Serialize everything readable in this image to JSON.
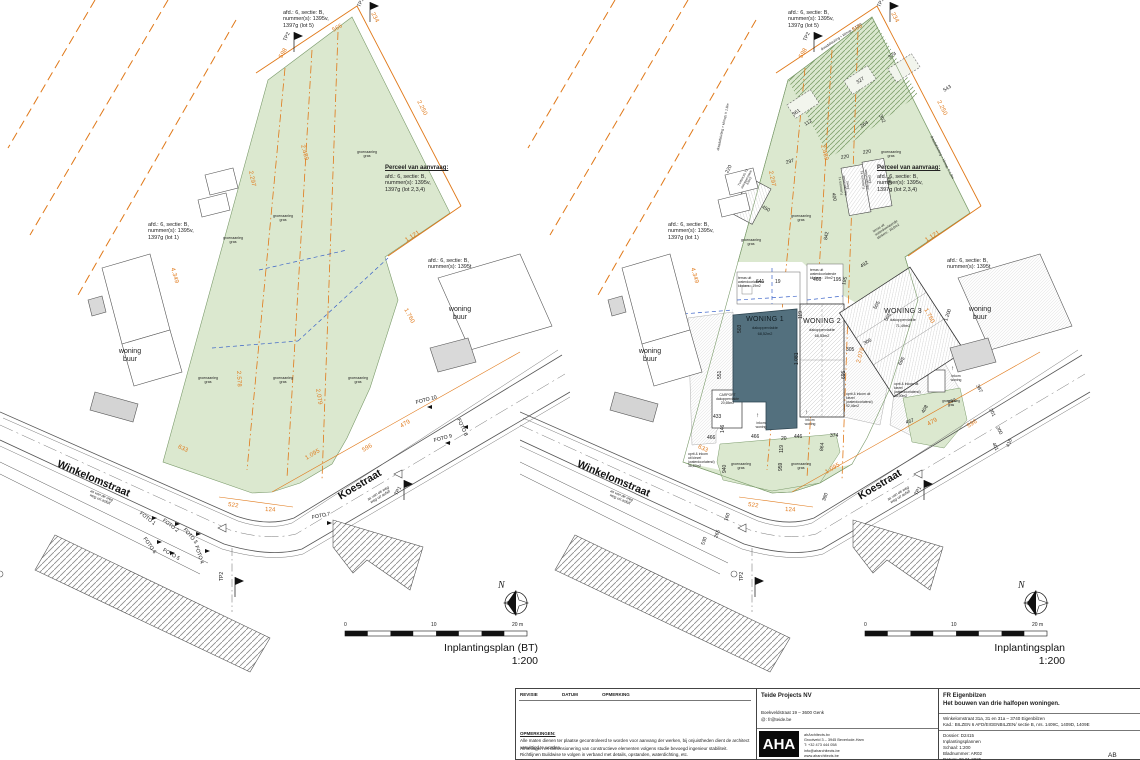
{
  "C": {
    "lot5": "afd.: 6, sectie: B,\nnummer(s): 1395v,\n1397g (lot 5)",
    "lot1": "afd.: 6, sectie: B,\nnummer(s): 1395v,\n1397g (lot 1)",
    "lot1395t": "afd.: 6, sectie: B,\nnummer(s): 1395t",
    "perceel_title": "Perceel van aanvraag:",
    "perceel_body": "afd.: 6, sectie: B,\nnummer(s): 1395v,\n1397g (lot 2,3,4)",
    "woning_buur": "woning\nbuur",
    "groen": "groenaanleg\ngras",
    "street_winkelomstraat": "Winkelomstraat",
    "street_koestraat": "Koestraat",
    "as_weg": "as van de weg\nweg uit asfalt",
    "tp1": "TP1",
    "tp2": "TP2",
    "north": "N",
    "scale_0": "0",
    "scale_10": "10",
    "scale_20": "20 m",
    "accent_orange": "#e07818",
    "green_fill": "#dbe8cf",
    "woning1_fill": "#53707e"
  },
  "L": {
    "caption": "Inplantingsplan (BT)",
    "scale": "1:200",
    "fotos": [
      "FOTO 1",
      "FOTO 2",
      "FOTO 3",
      "FOTO 4",
      "FOTO 5",
      "FOTO 6",
      "FOTO 7",
      "FOTO 8",
      "FOTO 9",
      "FOTO 10"
    ],
    "d": {
      "n598": "598",
      "n566": "566",
      "n234": "234",
      "n2250": "2.250",
      "n1121": "1.121",
      "n2297": "2.297",
      "n2489": "2.489",
      "n4349": "4.349",
      "n1760": "1.760",
      "n2578": "2.578",
      "n2079": "2.079",
      "n633": "633",
      "n522": "522",
      "n124": "124",
      "n1095": "1.095",
      "n596": "596",
      "n479": "479"
    }
  },
  "R": {
    "caption": "Inplantingsplan",
    "scale": "1:200",
    "w1": "WONING 1",
    "w1_sub": "dakoppervlakte",
    "w1_area": "68,52m2",
    "w2": "WONING 2",
    "w2_sub": "dakoppervlakte",
    "w2_area": "68,53m2",
    "w3": "WONING 3",
    "w3_sub": "dakoppervlakte",
    "w3_area": "71,49m2",
    "carport": "CARPORT\ndakoppervlakte\n20,65m2",
    "t1": "TUINHUIS T1\ndakoppervlakte\n8.8m2",
    "t2": "TUINHUIS T2\ndakoppervlakte\n8.8m2",
    "terras19": "terras uit\nwaterdoorlatende\nklinkers : 19m2",
    "terras20": "terras uit\nwaterdoorlatende\nklinkers : 20,0m2",
    "oprit1": "oprit & inkom\nuit kiezel\n(waterdoorlatend)\n36,87m2",
    "oprit2": "oprit & inkom uit\nkiezel\n(waterdoorlatend)\n92,46m2",
    "oprit3": "oprit & inkom uit\nkiezel\n(waterdoorlatend)\n45,00m2",
    "inkom": "inkom\nwoning",
    "inkom_arrow": "↑",
    "draad": "draadafsluiting + klimop, h 1,8m",
    "d": {
      "n598": "598",
      "n566": "566",
      "n234": "234",
      "n2250": "2.250",
      "n1121": "1.121",
      "n2297": "2.297",
      "n2489": "2.489",
      "n4349": "4.349",
      "n1760": "1.760",
      "n1200": "1.200",
      "n2079": "2.079",
      "n633": "633",
      "n522": "522",
      "n124": "124",
      "n1095": "1.095",
      "n596": "596",
      "n479": "479",
      "n641": "641",
      "n19": "19",
      "n466a": "466",
      "n195a": "195",
      "n195b": "195",
      "n492a": "492",
      "n505a": "505",
      "n505b": "505",
      "n306": "306",
      "n305": "305",
      "n503": "503",
      "n551": "551",
      "n119a": "119",
      "n1081": "1.081",
      "n695a": "695",
      "n695b": "695",
      "n433": "433",
      "n146": "146",
      "n466b": "466",
      "n466c": "466",
      "n20": "20",
      "n119b": "119",
      "n446": "446",
      "n374": "374",
      "n864": "864",
      "n940": "940",
      "n959": "959",
      "n380": "380",
      "n530": "530",
      "n265": "265",
      "n160": "160",
      "n416": "416",
      "n467": "467",
      "n408": "408",
      "n492b": "492",
      "n387": "387",
      "n201": "201",
      "n200": "200",
      "n401": "401",
      "n220a": "220",
      "n220b": "220",
      "n220c": "220",
      "n400": "400",
      "n460": "460",
      "n450": "450",
      "n842": "842",
      "n297": "297",
      "n361": "361",
      "n327": "327",
      "n374b": "374",
      "n543": "543",
      "n264": "264",
      "n112": "112",
      "n302": "302"
    }
  },
  "T": {
    "rev": "REVISIE",
    "datum": "DATUM",
    "opmerking": "OPMERKING",
    "opm_title": "OPMERKINGEN:",
    "opm1": "Alle maten dienen ter plaatse gecontroleerd te worden voor aanvang der werken, bij onjuistheden dient de architect verwittigd te worden.",
    "opm2": "Afmetingen en dimensionering van constructieve elementen volgens studie bevoegd ingenieur stabiliteit.",
    "opm3": "Richtlijnen Buildwise te volgen in verband met details, opstanden, waterdichting, etc. (https://www.buildwise.be/nl/bouwdetails)",
    "company": "Teide Projects NV",
    "company_addr": "Boekveldstraat 19 – 3600 Genk",
    "company_mail": "@: fr@teide.be",
    "logo": "AHA",
    "arch1": "ahArchitects.bv",
    "arch2": "Grootveld 3 – 3945 Beverlode-Ham",
    "arch3": "T: +32 473 444 058",
    "arch4": "info@aharchitects.be",
    "arch5": "www.aharchitects.be",
    "client": "FR Eigenbilzen",
    "project": "Het bouwen van drie halfopen woningen.",
    "addr": "Winkelomstraat 31a, 31 en 31a – 3740 Eigenbilzen",
    "kad": "Kad.: BILZEN 6 AFD/EIGENBILZEN/ sectie B, nrs. 1409C, 1409D, 1409E",
    "dossier": "Dossier: D2415",
    "plannen": "Inplantingsplannen",
    "schaal": "Schaal: 1:200",
    "blad": "Bladnummer: AR02",
    "datum_v": "Datum: 20.01.2025",
    "page": "AB"
  }
}
